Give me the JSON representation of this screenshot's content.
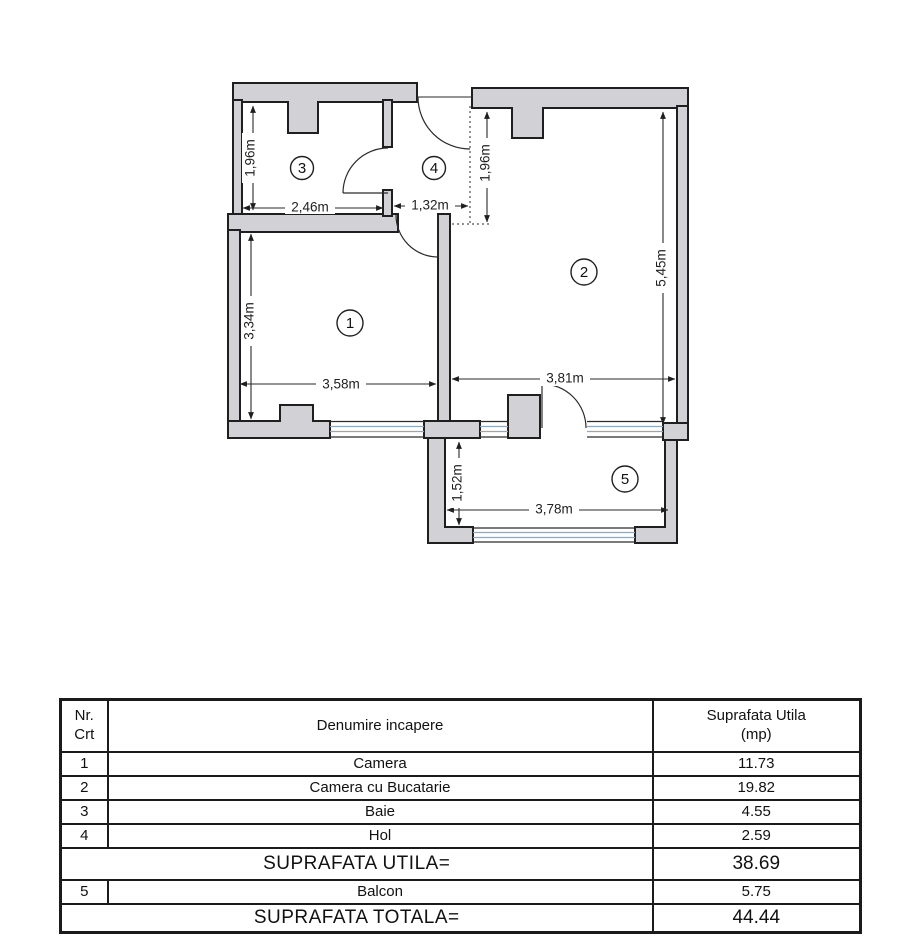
{
  "plan": {
    "rooms": {
      "camera": "1",
      "living": "2",
      "baie": "3",
      "hol": "4",
      "balcon": "5"
    },
    "dims": {
      "baie_h": "1,96m",
      "baie_w": "2,46m",
      "hol_w": "1,32m",
      "hol_h": "1,96m",
      "living_h": "5,45m",
      "camera_h": "3,34m",
      "camera_w": "3,58m",
      "living_w": "3,81m",
      "balcon_h": "1,52m",
      "balcon_w": "3,78m"
    },
    "colors": {
      "wall_fill": "#d2d2d6",
      "wall_stroke": "#1f1f1f",
      "window_line": "#8fa8bc",
      "dim_line": "#2a2a2a"
    }
  },
  "table": {
    "header": {
      "col1_line1": "Nr.",
      "col1_line2": "Crt",
      "col2": "Denumire incapere",
      "col3_line1": "Suprafata Utila",
      "col3_line2": "(mp)"
    },
    "rows": [
      {
        "nr": "1",
        "name": "Camera",
        "area": "11.73"
      },
      {
        "nr": "2",
        "name": "Camera cu Bucatarie",
        "area": "19.82"
      },
      {
        "nr": "3",
        "name": "Baie",
        "area": "4.55"
      },
      {
        "nr": "4",
        "name": "Hol",
        "area": "2.59"
      }
    ],
    "subtotal": {
      "label": "SUPRAFATA UTILA=",
      "value": "38.69"
    },
    "balcon": {
      "nr": "5",
      "name": "Balcon",
      "area": "5.75"
    },
    "total": {
      "label": "SUPRAFATA TOTALA=",
      "value": "44.44"
    }
  }
}
